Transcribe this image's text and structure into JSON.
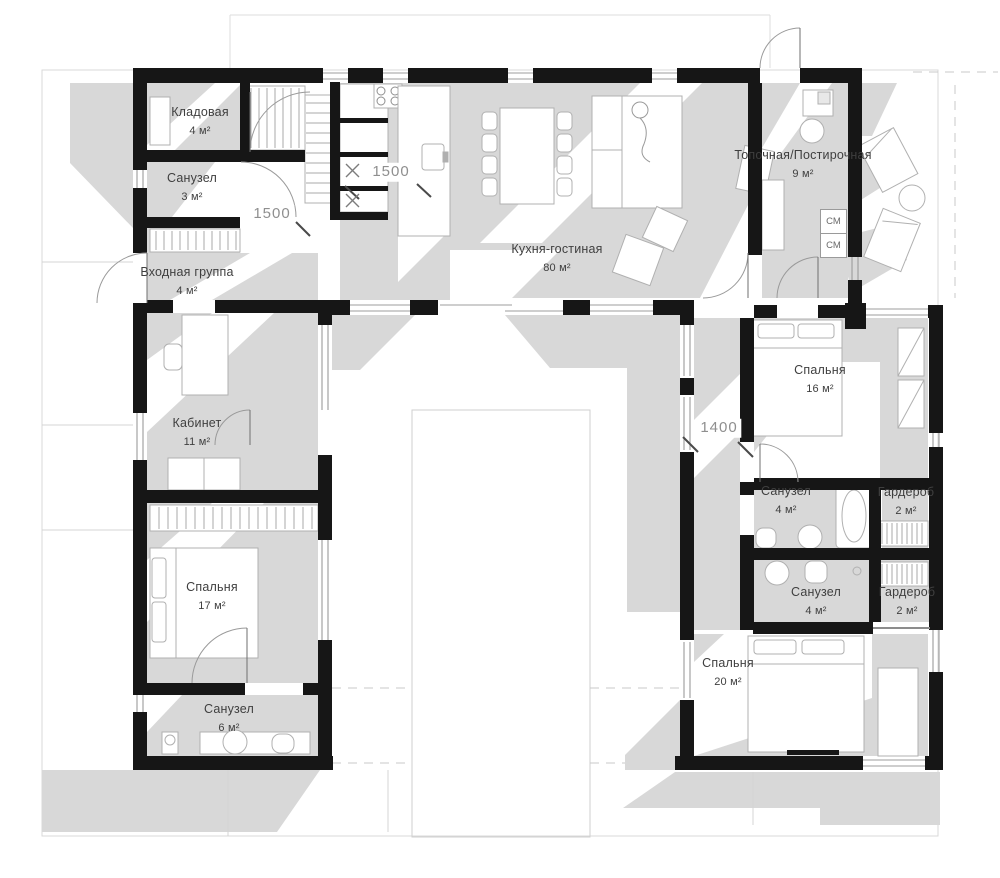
{
  "plan": {
    "title": "U-shaped house floor plan",
    "rooms": [
      {
        "name": "Кладовая",
        "area": "4 м²"
      },
      {
        "name": "Санузел",
        "area": "3 м²"
      },
      {
        "name": "Входная группа",
        "area": "4 м²"
      },
      {
        "name": "Кухня-гостиная",
        "area": "80 м²"
      },
      {
        "name": "Топочная/Постирочная",
        "area": "9 м²"
      },
      {
        "name": "Кабинет",
        "area": "11 м²"
      },
      {
        "name": "Спальня",
        "area": "16 м²"
      },
      {
        "name": "Санузел",
        "area": "4 м²"
      },
      {
        "name": "Гардероб",
        "area": "2 м²"
      },
      {
        "name": "Санузел",
        "area": "4 м²"
      },
      {
        "name": "Гардероб",
        "area": "2 м²"
      },
      {
        "name": "Спальня",
        "area": "17 м²"
      },
      {
        "name": "Санузел",
        "area": "6 м²"
      },
      {
        "name": "Спальня",
        "area": "20 м²"
      }
    ],
    "dimensions": [
      {
        "text": "1500"
      },
      {
        "text": "1500"
      },
      {
        "text": "1400"
      }
    ],
    "appliances": [
      {
        "text": "СМ"
      },
      {
        "text": "СМ"
      }
    ],
    "colors": {
      "wall": "#161616",
      "shadow": "#d8d8d8",
      "furniture_stroke": "#b0b0b0",
      "label": "#3f3f3f",
      "dimension": "#8f8f8f",
      "faint_line": "#d4d4d4"
    }
  }
}
